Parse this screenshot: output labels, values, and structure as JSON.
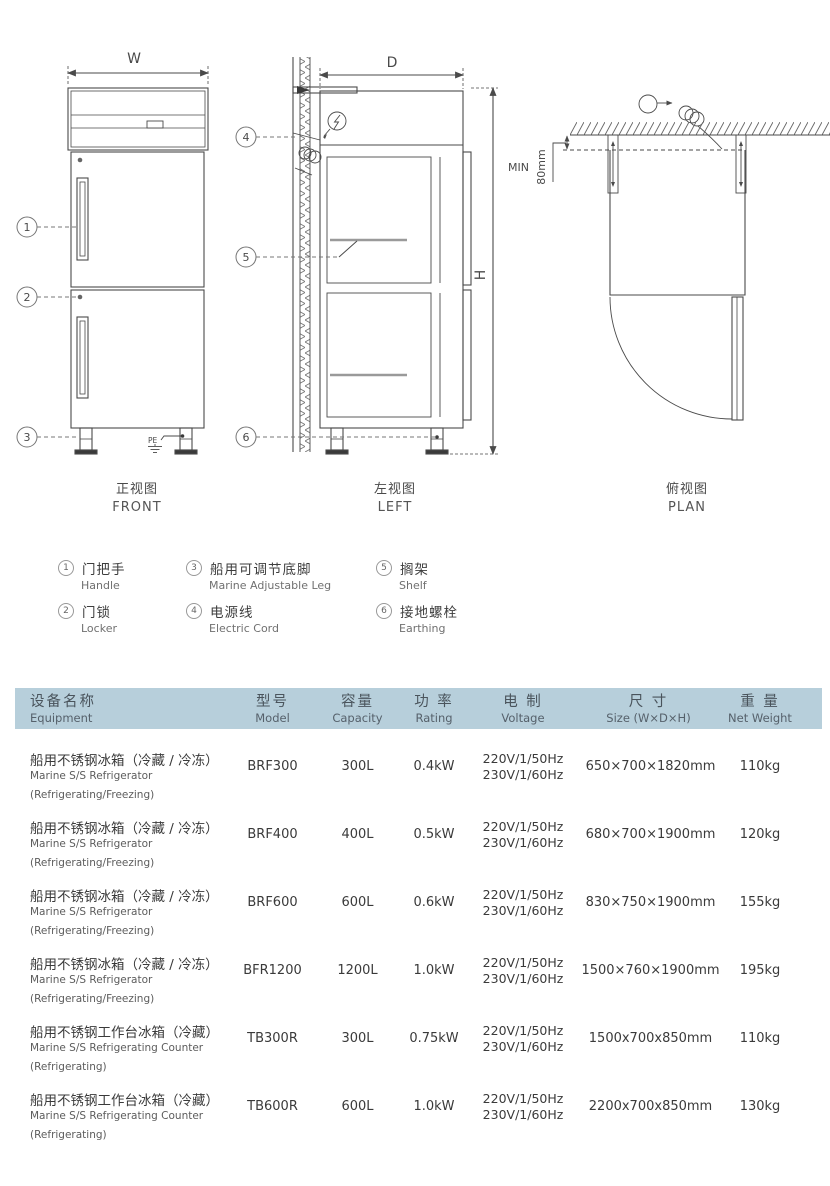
{
  "drawings": {
    "front": {
      "dim_w": "W",
      "pe": "PE",
      "label_zh": "正视图",
      "label_en": "FRONT"
    },
    "left": {
      "dim_d": "D",
      "dim_h": "H",
      "label_zh": "左视图",
      "label_en": "LEFT"
    },
    "plan": {
      "min": "MIN",
      "clearance": "80mm",
      "label_zh": "俯视图",
      "label_en": "PLAN"
    }
  },
  "legend": {
    "items": [
      {
        "num": "1",
        "zh": "门把手",
        "en": "Handle"
      },
      {
        "num": "2",
        "zh": "门锁",
        "en": "Locker"
      },
      {
        "num": "3",
        "zh": "船用可调节底脚",
        "en": "Marine Adjustable Leg"
      },
      {
        "num": "4",
        "zh": "电源线",
        "en": "Electric Cord"
      },
      {
        "num": "5",
        "zh": "搁架",
        "en": "Shelf"
      },
      {
        "num": "6",
        "zh": "接地螺栓",
        "en": "Earthing"
      }
    ]
  },
  "table": {
    "header": {
      "equipment": {
        "zh": "设备名称",
        "en": "Equipment"
      },
      "model": {
        "zh": "型号",
        "en": "Model"
      },
      "capacity": {
        "zh": "容量",
        "en": "Capacity"
      },
      "rating": {
        "zh": "功 率",
        "en": "Rating"
      },
      "voltage": {
        "zh": "电 制",
        "en": "Voltage"
      },
      "size": {
        "zh": "尺 寸",
        "en": "Size (W×D×H)"
      },
      "weight": {
        "zh": "重 量",
        "en": "Net Weight"
      }
    },
    "rows": [
      {
        "name_zh": "船用不锈钢冰箱（冷藏 / 冷冻）",
        "name_en": "Marine S/S Refrigerator",
        "name_note": "(Refrigerating/Freezing)",
        "model": "BRF300",
        "capacity": "300L",
        "rating": "0.4kW",
        "voltage1": "220V/1/50Hz",
        "voltage2": "230V/1/60Hz",
        "size": "650×700×1820mm",
        "weight": "110kg"
      },
      {
        "name_zh": "船用不锈钢冰箱（冷藏 / 冷冻）",
        "name_en": "Marine S/S Refrigerator",
        "name_note": "(Refrigerating/Freezing)",
        "model": "BRF400",
        "capacity": "400L",
        "rating": "0.5kW",
        "voltage1": "220V/1/50Hz",
        "voltage2": "230V/1/60Hz",
        "size": "680×700×1900mm",
        "weight": "120kg"
      },
      {
        "name_zh": "船用不锈钢冰箱（冷藏 / 冷冻）",
        "name_en": "Marine S/S Refrigerator",
        "name_note": "(Refrigerating/Freezing)",
        "model": "BRF600",
        "capacity": "600L",
        "rating": "0.6kW",
        "voltage1": "220V/1/50Hz",
        "voltage2": "230V/1/60Hz",
        "size": "830×750×1900mm",
        "weight": "155kg"
      },
      {
        "name_zh": "船用不锈钢冰箱（冷藏 / 冷冻）",
        "name_en": "Marine S/S Refrigerator",
        "name_note": "(Refrigerating/Freezing)",
        "model": "BFR1200",
        "capacity": "1200L",
        "rating": "1.0kW",
        "voltage1": "220V/1/50Hz",
        "voltage2": "230V/1/60Hz",
        "size": "1500×760×1900mm",
        "weight": "195kg"
      },
      {
        "name_zh": "船用不锈钢工作台冰箱（冷藏）",
        "name_en": "Marine S/S Refrigerating Counter",
        "name_note": "(Refrigerating)",
        "model": "TB300R",
        "capacity": "300L",
        "rating": "0.75kW",
        "voltage1": "220V/1/50Hz",
        "voltage2": "230V/1/60Hz",
        "size": "1500x700x850mm",
        "weight": "110kg"
      },
      {
        "name_zh": "船用不锈钢工作台冰箱（冷藏）",
        "name_en": "Marine S/S Refrigerating Counter",
        "name_note": "(Refrigerating)",
        "model": "TB600R",
        "capacity": "600L",
        "rating": "1.0kW",
        "voltage1": "220V/1/50Hz",
        "voltage2": "230V/1/60Hz",
        "size": "2200x700x850mm",
        "weight": "130kg"
      }
    ]
  },
  "colors": {
    "header_bg": "#b7cfdb",
    "line": "#4a4a4a",
    "text_dark": "#3a3a3a",
    "text_gray": "#5c5c5c"
  }
}
